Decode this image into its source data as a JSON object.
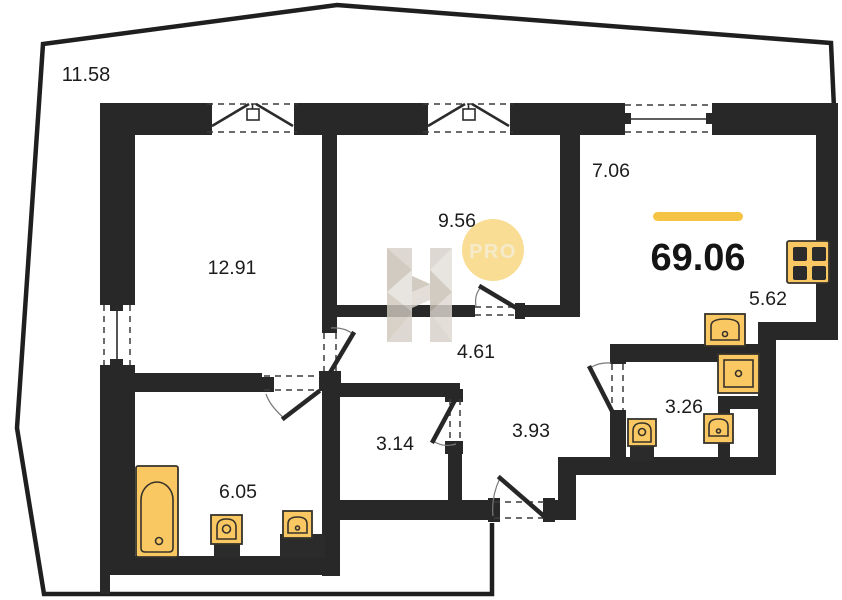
{
  "plan": {
    "total_area": "69.06",
    "rooms": {
      "terrace": "11.58",
      "bedroom": "12.91",
      "room2": "9.56",
      "living": "7.06",
      "hall_upper": "4.61",
      "closet": "3.14",
      "hall_lower": "3.93",
      "bathroom_big": "6.05",
      "kitchen": "5.62",
      "bathroom_small": "3.26"
    },
    "watermark": {
      "letter": "H",
      "badge_text": "PRO"
    },
    "fixtures": [
      "bathtub",
      "toilet",
      "sink",
      "shower",
      "kitchen-sink",
      "stove",
      "duct-shaft"
    ],
    "colors": {
      "wall": "#282828",
      "outline": "#1F1F1F",
      "fixture_fill": "#FAC863",
      "fixture_stroke": "#37332B",
      "accent_bar": "#F6C445",
      "badge_fill": "#F8D67E",
      "badge_text": "#F3E6BE",
      "watermark_light": "#E4DFD8",
      "watermark_mid": "#D6D0C7",
      "watermark_dark": "#C8C0B5"
    }
  }
}
